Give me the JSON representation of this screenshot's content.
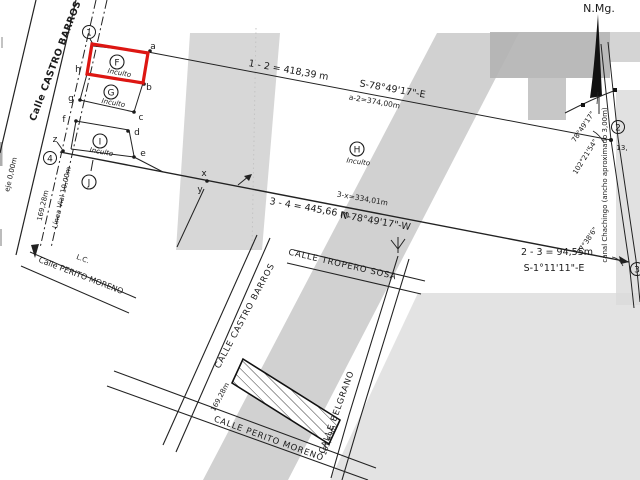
{
  "colors": {
    "highlight_red": "#dd1612",
    "ink": "#1b1b1b",
    "watermark_gray": "#c9c9c9"
  },
  "main_plan": {
    "streets": {
      "castro_barros": "Calle CASTRO BARROS",
      "perito_moreno": "Calle PERITO MORENO"
    },
    "labels": {
      "north": "N.Mg.",
      "lc": "L.C.",
      "eje": "eje 0,00m",
      "frontage": "169,28m",
      "linea_vial": "Línea Vial 10,00m",
      "canal": "canal Chachingo (ancho aproximado 3,00m)",
      "partial_13": "13,"
    },
    "vertices": {
      "v1": "1",
      "v2": "2",
      "v3": "3",
      "v4": "4",
      "a": "a",
      "b": "b",
      "c": "c",
      "d": "d",
      "e": "e",
      "f": "f",
      "g": "g",
      "h": "h",
      "x": "x",
      "y": "y",
      "z": "z"
    },
    "parcels": {
      "f": {
        "id": "F",
        "status": "Inculto"
      },
      "g": {
        "id": "G",
        "status": "Inculto"
      },
      "h": {
        "id": "H",
        "status": "Inculto"
      },
      "i": {
        "id": "I",
        "status": "Inculto"
      },
      "j": {
        "id": "J",
        "status": ""
      }
    },
    "measurements": {
      "side_1_2": "1 - 2 = 418,39 m",
      "bearing_1_2": "S-78°49'17\"-E",
      "partial_a_2": "a-2=374,00m",
      "partial_3_x": "3-x=334,01m",
      "side_3_4": "3 - 4 = 445,66 m",
      "bearing_3_4": "N-78°49'17\"-W",
      "side_2_3": "2 - 3 = 94,55m",
      "bearing_2_3": "S-1°11'11\"-E",
      "angle_at_2_outer": "78°49'17\"",
      "angle_at_2_inner": "102°21'54\"",
      "angle_at_3": "77°38'6\""
    }
  },
  "inset_map": {
    "streets": {
      "castro_barros": "CALLE CASTRO BARROS",
      "tropero_sosa": "CALLE TROPERO SOSA",
      "belgrano": "CALLE BELGRANO",
      "perito_moreno": "CALLE PERITO MORENO"
    },
    "labels": {
      "frontage": "169,28m",
      "depth": "181,69m"
    }
  }
}
